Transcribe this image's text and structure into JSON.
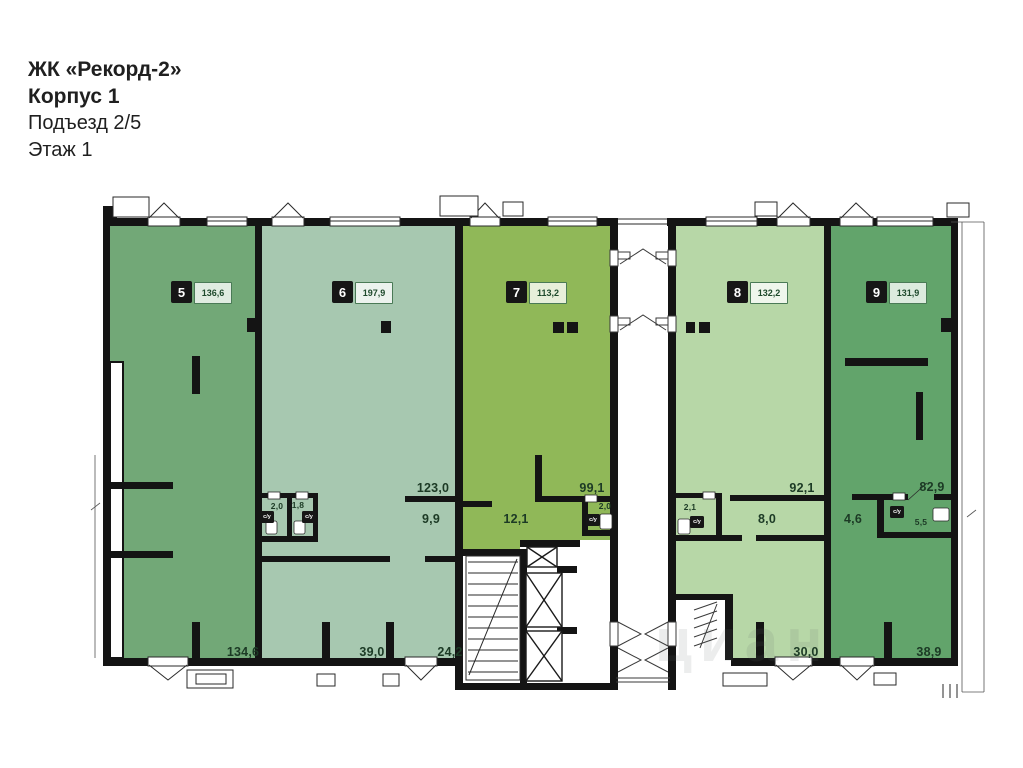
{
  "header": {
    "complex": "ЖК «Рекорд-2»",
    "building": "Корпус 1",
    "entrance": "Подъезд 2/5",
    "floor": "Этаж 1"
  },
  "watermark": "циан",
  "labels": {
    "wc": "с/у"
  },
  "colors": {
    "wall": "#141414",
    "room_label": "#1c3a25",
    "badge_bg": "#161616",
    "badge_text": "#ffffff",
    "chip_text": "#1e4a2c",
    "chip_border": "#4a7a56"
  },
  "units": [
    {
      "number": "5",
      "area": "136,6",
      "color": "#72A877",
      "rooms": [
        "134,6"
      ]
    },
    {
      "number": "6",
      "area": "197,9",
      "color": "#A7C8B0",
      "rooms": [
        "123,0",
        "9,9",
        "2,0",
        "1,8",
        "39,0",
        "24,2"
      ]
    },
    {
      "number": "7",
      "area": "113,2",
      "color": "#90B858",
      "rooms": [
        "99,1",
        "12,1",
        "2,0"
      ]
    },
    {
      "number": "8",
      "area": "132,2",
      "color": "#B7D7A7",
      "rooms": [
        "92,1",
        "8,0",
        "2,1",
        "30,0"
      ]
    },
    {
      "number": "9",
      "area": "131,9",
      "color": "#62A46B",
      "rooms": [
        "82,9",
        "4,6",
        "5,5",
        "38,9"
      ]
    }
  ]
}
